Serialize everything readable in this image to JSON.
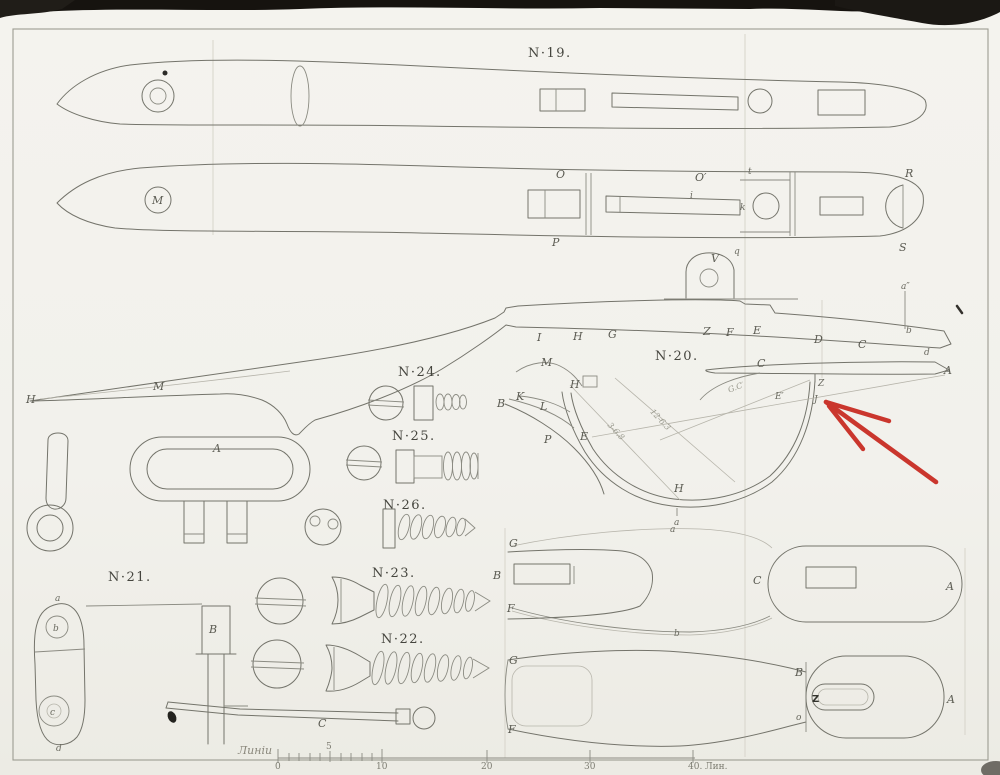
{
  "sheet": {
    "note": "Лист. 4."
  },
  "titles": {
    "n19": "N·19.",
    "n20": "N·20.",
    "n21": "N·21.",
    "n22": "N·22.",
    "n23": "N·23.",
    "n24": "N·24.",
    "n25": "N·25.",
    "n26": "N·26."
  },
  "channel_view": {
    "m": "M",
    "o": "O",
    "o_prime": "O′",
    "p": "P",
    "i": "i",
    "k": "k",
    "t": "t",
    "q": "q",
    "r": "R",
    "s": "S"
  },
  "side_profile": {
    "h_tip": "H",
    "m": "M",
    "v": "V",
    "i": "I",
    "h": "H",
    "g": "G",
    "z": "Z",
    "f": "F",
    "e": "E",
    "d": "D",
    "c": "C",
    "a_mark": "a″",
    "b_mark": "b",
    "d_mark": "d"
  },
  "guard": {
    "c": "C",
    "a": "A",
    "z": "Z",
    "j": "J",
    "gc": "G.C′",
    "e_prime": "E′",
    "m": "M",
    "h_top": "H",
    "k": "K",
    "l": "L",
    "b": "B",
    "p": "P",
    "e": "E",
    "h_bottom": "H",
    "a_bottom": "a",
    "dim_left": "3-6.8",
    "dim_right": "12-6.3"
  },
  "bow_front": {
    "a": "A"
  },
  "side_plate": {
    "a": "a",
    "b": "b",
    "c": "c",
    "d": "d",
    "bar": "B"
  },
  "rod": {
    "c": "C"
  },
  "spring_plate": {
    "g": "G",
    "b": "B",
    "f": "F",
    "a_top": "a",
    "b_bot": "b",
    "c": "C",
    "a_end": "A"
  },
  "lower_plate": {
    "g": "G",
    "f": "F",
    "b": "B",
    "z": "Z",
    "o": "o",
    "a": "A"
  },
  "scale": {
    "caption": "Линіи",
    "n0": "0",
    "n5": "5",
    "n10": "10",
    "n20": "20",
    "n30": "30",
    "n40": "40. Лин."
  },
  "colors": {
    "arrow": "#c7271d",
    "ink": "#74746b",
    "paper": "#f2f1ec"
  }
}
